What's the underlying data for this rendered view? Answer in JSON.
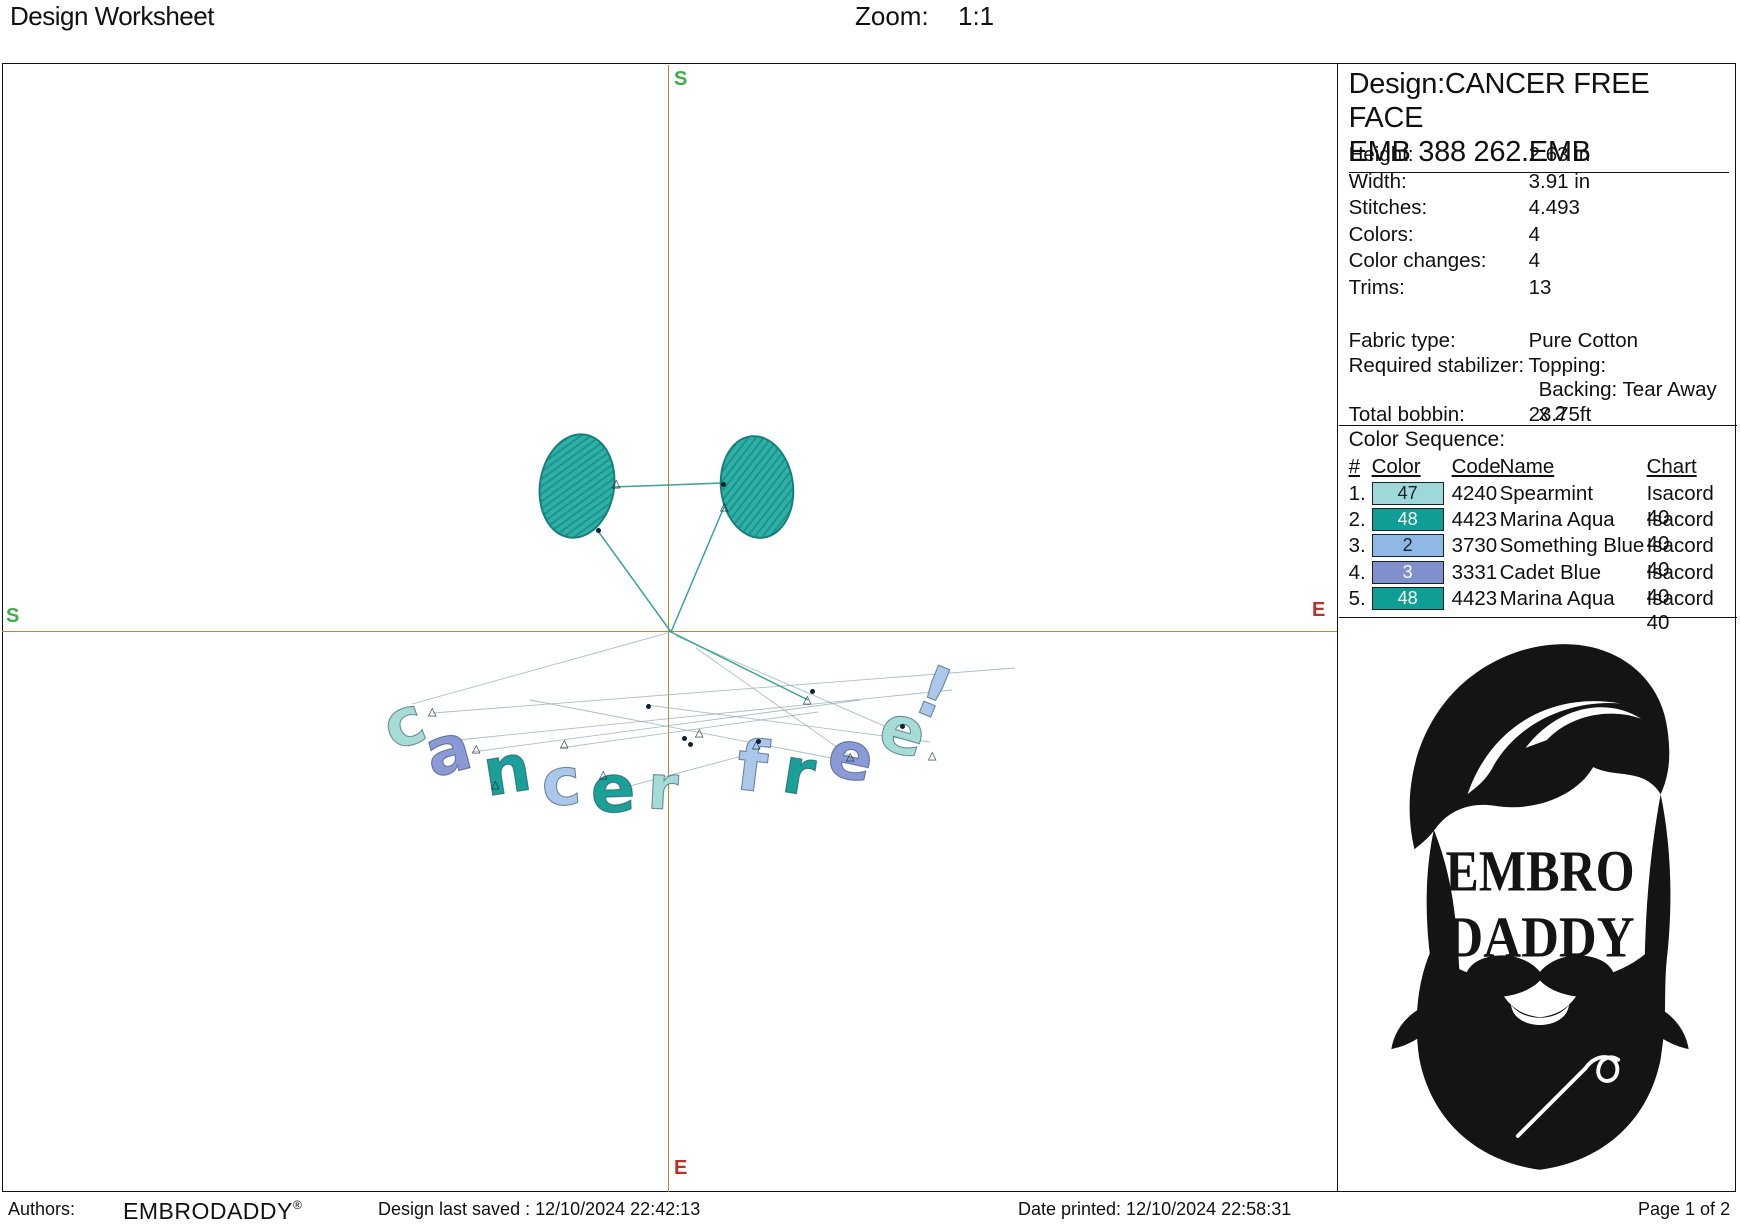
{
  "header": {
    "title": "Design Worksheet",
    "zoom_label": "Zoom:",
    "zoom_value": "1:1"
  },
  "canvas": {
    "axis_labels": {
      "top": "S",
      "left": "S",
      "right": "E",
      "bottom": "E"
    },
    "colors": {
      "crosshair": "#ab8c3d",
      "start_green": "#3fae47",
      "end_red": "#b5332a"
    }
  },
  "design_preview": {
    "eye_fill": "#2fb0a7",
    "eye_hatch": "#1c938c",
    "eye_border": "#157f7a",
    "thread_teal": "#2f9f98",
    "thread_faint": "#8fa9b4",
    "letter_palette": {
      "spearmint": "#a5dcd6",
      "marina": "#1aa099",
      "blue": "#abc7ea",
      "cadet": "#8b99d6"
    },
    "eyes": [
      {
        "cx": 577,
        "cy": 486,
        "rx": 38,
        "ry": 53,
        "rot": 9
      },
      {
        "cx": 757,
        "cy": 487,
        "rx": 37,
        "ry": 52,
        "rot": -7
      }
    ],
    "letters": [
      {
        "ch": "c",
        "x": 404,
        "y": 727,
        "rot": -20,
        "size": 66,
        "color": "spearmint"
      },
      {
        "ch": "a",
        "x": 448,
        "y": 754,
        "rot": -15,
        "size": 66,
        "color": "cadet"
      },
      {
        "ch": "n",
        "x": 507,
        "y": 774,
        "rot": -9,
        "size": 66,
        "color": "marina"
      },
      {
        "ch": "c",
        "x": 561,
        "y": 786,
        "rot": -5,
        "size": 66,
        "color": "blue"
      },
      {
        "ch": "e",
        "x": 613,
        "y": 793,
        "rot": -2,
        "size": 66,
        "color": "marina"
      },
      {
        "ch": "r",
        "x": 663,
        "y": 791,
        "rot": 3,
        "size": 62,
        "color": "spearmint"
      },
      {
        "ch": "f",
        "x": 752,
        "y": 770,
        "rot": 7,
        "size": 70,
        "color": "blue"
      },
      {
        "ch": "r",
        "x": 799,
        "y": 776,
        "rot": 9,
        "size": 64,
        "color": "marina"
      },
      {
        "ch": "e",
        "x": 851,
        "y": 760,
        "rot": 12,
        "size": 66,
        "color": "cadet"
      },
      {
        "ch": "e",
        "x": 903,
        "y": 735,
        "rot": 16,
        "size": 66,
        "color": "spearmint"
      },
      {
        "ch": "!",
        "x": 934,
        "y": 696,
        "rot": 22,
        "size": 70,
        "color": "blue"
      }
    ],
    "threads_teal": [
      [
        613,
        487,
        723,
        483
      ],
      [
        598,
        531,
        671,
        632
      ],
      [
        671,
        632,
        724,
        507
      ],
      [
        671,
        632,
        808,
        700
      ]
    ],
    "threads_faint": [
      [
        433,
        713,
        1015,
        668
      ],
      [
        458,
        740,
        952,
        690
      ],
      [
        472,
        752,
        860,
        700
      ],
      [
        530,
        700,
        842,
        760
      ],
      [
        560,
        748,
        818,
        712
      ],
      [
        615,
        790,
        757,
        752
      ],
      [
        647,
        705,
        930,
        742
      ],
      [
        676,
        636,
        903,
        734
      ],
      [
        412,
        704,
        671,
        632
      ],
      [
        696,
        648,
        851,
        757
      ]
    ],
    "markers_tri": [
      [
        617,
        484
      ],
      [
        725,
        507
      ],
      [
        433,
        712
      ],
      [
        477,
        749
      ],
      [
        565,
        744
      ],
      [
        700,
        733
      ],
      [
        808,
        700
      ],
      [
        851,
        757
      ],
      [
        933,
        756
      ],
      [
        757,
        745
      ],
      [
        604,
        775
      ],
      [
        496,
        785
      ]
    ],
    "markers_dot": [
      [
        598,
        530
      ],
      [
        723,
        484
      ],
      [
        690,
        744
      ],
      [
        684,
        738
      ],
      [
        812,
        691
      ],
      [
        902,
        726
      ],
      [
        758,
        741
      ],
      [
        648,
        706
      ]
    ]
  },
  "info_panel": {
    "design_title_line1": "Design:CANCER FREE FACE",
    "design_title_line2": "EMB 388 262.EMB",
    "specs": [
      {
        "label": "Height:",
        "value": "2.63 in"
      },
      {
        "label": "Width:",
        "value": "3.91 in"
      },
      {
        "label": "Stitches:",
        "value": "4.493"
      },
      {
        "label": "Colors:",
        "value": "4"
      },
      {
        "label": "Color changes:",
        "value": "4"
      },
      {
        "label": "Trims:",
        "value": "13"
      }
    ],
    "fabric_rows": [
      {
        "label": "Fabric type:",
        "value": "Pure Cotton",
        "indent": false
      },
      {
        "label": "Required stabilizer:",
        "value": "Topping:",
        "indent": false
      },
      {
        "label": "",
        "value": "Backing: Tear Away x 2",
        "indent": true
      },
      {
        "label": "Total bobbin:",
        "value": "23.75ft",
        "indent": false
      }
    ],
    "color_sequence": {
      "title": "Color Sequence:",
      "headers": [
        "#",
        "Color",
        "Code",
        "Name",
        "Chart"
      ],
      "rows": [
        {
          "num": "1.",
          "color_num": "47",
          "swatch": "#9fd8d8",
          "text": "dark",
          "code": "4240",
          "name": "Spearmint",
          "chart": "Isacord 40"
        },
        {
          "num": "2.",
          "color_num": "48",
          "swatch": "#0e9e96",
          "text": "light",
          "code": "4423",
          "name": "Marina Aqua",
          "chart": "Isacord 40"
        },
        {
          "num": "3.",
          "color_num": "2",
          "swatch": "#8fb8e4",
          "text": "dark",
          "code": "3730",
          "name": "Something Blue",
          "chart": "Isacord 40"
        },
        {
          "num": "4.",
          "color_num": "3",
          "swatch": "#8090cc",
          "text": "light",
          "code": "3331",
          "name": "Cadet Blue",
          "chart": "Isacord 40"
        },
        {
          "num": "5.",
          "color_num": "48",
          "swatch": "#0e9e96",
          "text": "light",
          "code": "4423",
          "name": "Marina Aqua",
          "chart": "Isacord 40"
        }
      ]
    },
    "logo": {
      "line1": "EMBRO",
      "line2": "DADDY",
      "color": "#141414"
    }
  },
  "footer": {
    "authors_label": "Authors:",
    "brand": "EMBRODADDY",
    "reg": "®",
    "last_saved": "Design last saved : 12/10/2024 22:42:13",
    "printed": "Date printed: 12/10/2024 22:58:31",
    "page": "Page 1 of 2"
  }
}
